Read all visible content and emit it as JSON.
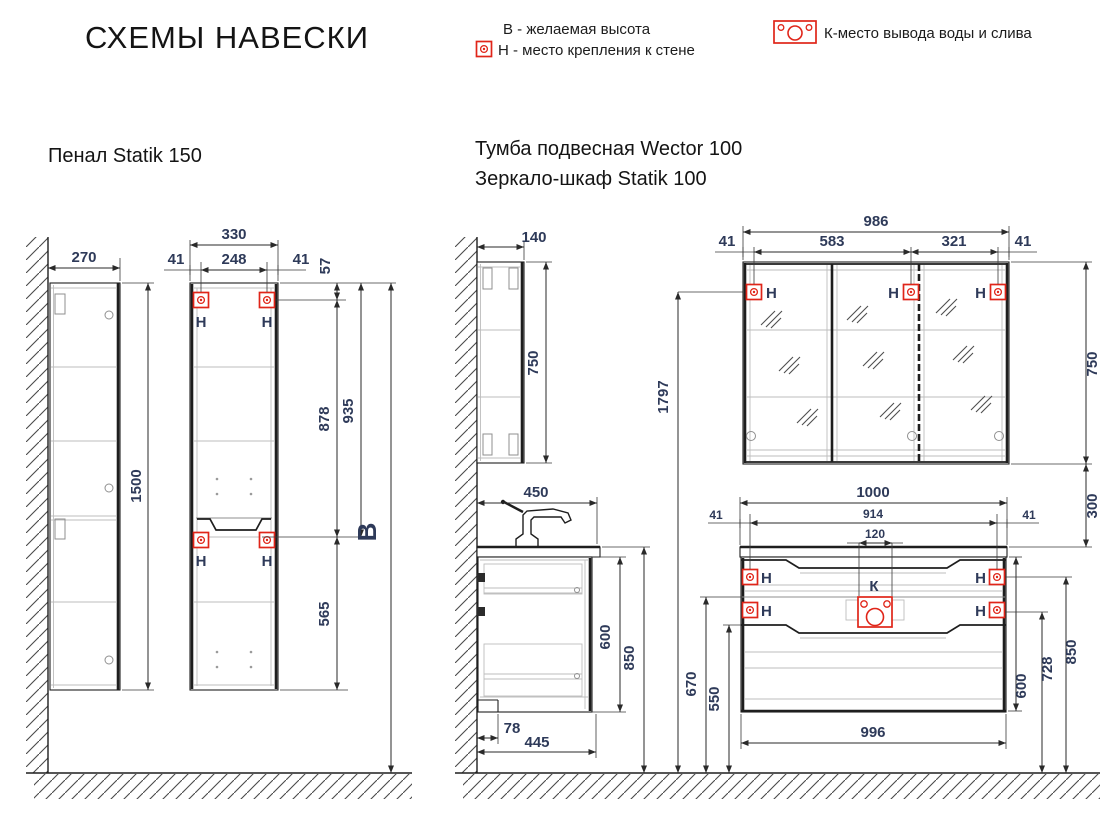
{
  "title": "СХЕМЫ НАВЕСКИ",
  "legend": {
    "height": "В - желаемая высота",
    "mount": "Н - место крепления к стене",
    "drain": "К-место вывода воды и слива"
  },
  "labels": {
    "mount": "Н",
    "drain": "К",
    "height": "В"
  },
  "colors": {
    "mark_red": "#e02519",
    "dim_text": "#2e3a59",
    "line": "#1e1e1e"
  },
  "penal": {
    "title": "Пенал Statik 150",
    "depth": "270",
    "height": "1500",
    "width": "330",
    "edge": "41",
    "span": "248",
    "top_offset": "57",
    "upper_gap": "878",
    "top_gap": "935",
    "lower_gap": "565"
  },
  "wector": {
    "title1": "Тумба подвесная Wector 100",
    "title2": "Зеркало-шкаф Statik 100",
    "mirror_depth": "140",
    "mirror_height": "750",
    "mirror_width": "986",
    "m_edge": "41",
    "m_span1": "583",
    "m_span2": "321",
    "mount_height": "1797",
    "gap": "300",
    "depth": "450",
    "width": "1000",
    "mount_span": "914",
    "drain_span": "120",
    "t_edge": "41",
    "bottom_width": "996",
    "body_height": "600",
    "mount_low": "728",
    "mount_up": "850",
    "side_height": "850",
    "left_up": "670",
    "left_low": "550",
    "plinth": "78",
    "bottom_depth": "445"
  }
}
